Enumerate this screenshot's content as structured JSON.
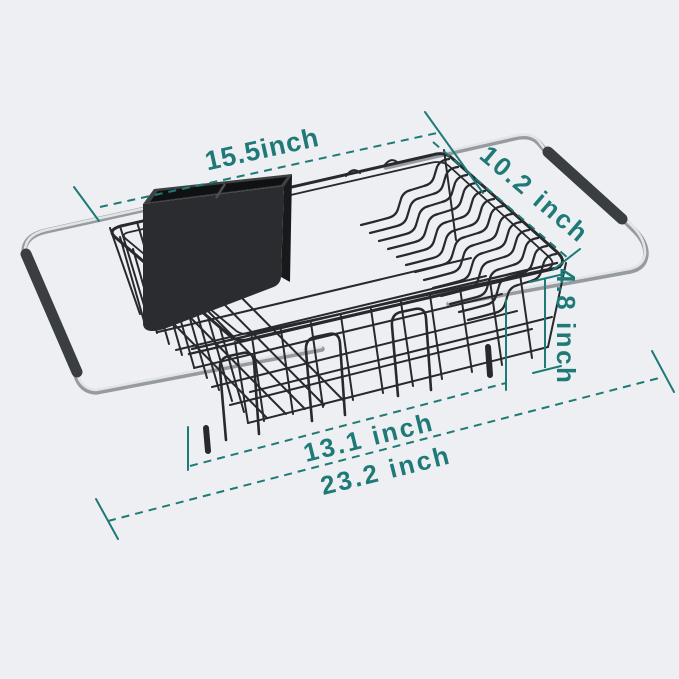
{
  "colors": {
    "background": "#edeff2",
    "dimension": "#1f7a77",
    "wire": "#27292c",
    "chrome_light": "#e2e5e8",
    "chrome_dark": "#969ba0",
    "grip": "#3a3d41",
    "caddy": "#2a2c2f"
  },
  "dimensions": {
    "top_length": {
      "label": "15.5inch"
    },
    "depth": {
      "label": "10.2 inch"
    },
    "height": {
      "label": "4.8 inch"
    },
    "basket_length": {
      "label": "13.1 inch"
    },
    "extended_length": {
      "label": "23.2 inch"
    }
  }
}
